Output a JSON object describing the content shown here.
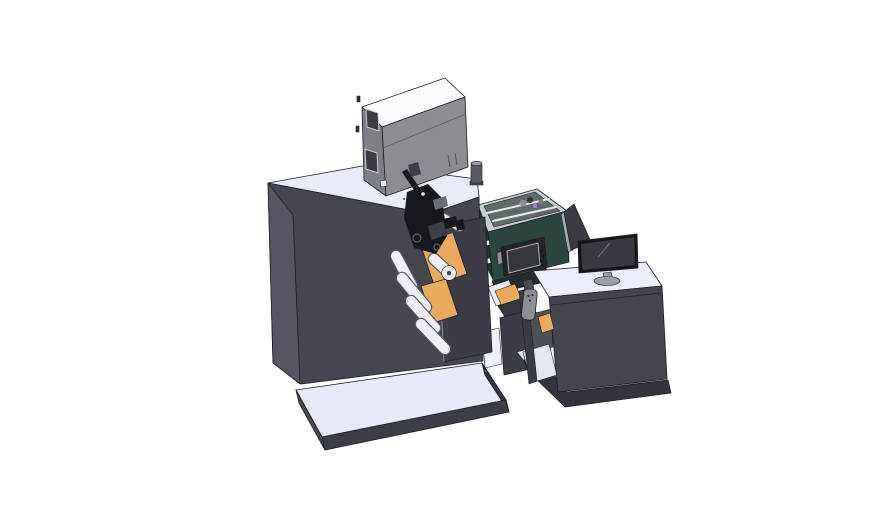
{
  "description": "3D CAD isometric render of an industrial label printing machine: large dark cabinet on a light floor platform with a gray enclosure box on top, orange material rolls and white guide rollers on a mount plate, black print-head assembly, dark teal process chamber with control-panel screen, transfer bridge with hanging pendant remote, and an operator desk with a flat monitor on a white desktop",
  "parts": [
    "process-chamber",
    "chamber-control-panel",
    "monitor-side-panel",
    "main-cabinet",
    "top-unit-box",
    "exhaust-canister",
    "roll-mount-plate",
    "material-rolls",
    "guide-rollers",
    "print-head-assembly",
    "transfer-bridge",
    "floor-platform",
    "desk-base",
    "operator-desk",
    "desk-shelf",
    "pendant-remote",
    "monitor"
  ],
  "colors": {
    "background": "#ffffff",
    "outline": "#1e1f23",
    "cabinetTop": "#e8ecf7",
    "cabinetFront": "#45464f",
    "cabinetSide": "#555662",
    "platformTop": "#e6eaf6",
    "platformFront": "#3c3d47",
    "platformSideL": "#474854",
    "platformSideR": "#343540",
    "boxTop": "#fbfcfe",
    "boxFront": "#8b8d93",
    "boxSide": "#7d7f85",
    "boxWindow": "#3c3d44",
    "boxWindowFrame": "#c9cbd1",
    "boxSeam": "#5c5e63",
    "boxGroove": "#55575e",
    "boxTab": "#2e2f34",
    "boxSquare": "#f4f6fa",
    "canisterBody": "#585a61",
    "canisterCap": "#9ba0a8",
    "canisterFoot": "#494b51",
    "plate": "#3b3c45",
    "plateEdge": "#8a8c94",
    "roller": "#edeff5",
    "rollerRim": "#595a61",
    "rollerHub": "#45464c",
    "orange": "#e9aa5e",
    "mech": "#17181b",
    "mechMid": "#3e3f46",
    "mechGray": "#6b6d73",
    "mechDot": "#e8eaee",
    "markDot": "#26272c",
    "chamberRim": "#c8cdd5",
    "chamberInterior": "#5e6b68",
    "chamberFront": "#2b463e",
    "chamberSide": "#1f342e",
    "chamberLower": "#262b2c",
    "strut": "#e9ebf1",
    "blobGray": "#8f9197",
    "blobDark": "#34353b",
    "blobMagenta": "#bd6fd6",
    "blobGray2": "#75777d",
    "hinge": "#f1f3f7",
    "panelBody": "#232423",
    "panelScreen": "#36373d",
    "panelScreenEdge": "#aeb1b7",
    "panelButton": "#151617",
    "panelKnob": "#8d8f95",
    "sidePanel": "#3a3b43",
    "sidePanelEdge": "#a7a9b0",
    "deskTop": "#ebeef8",
    "deskFront": "#44454e",
    "deskSeam": "#23242a",
    "shelfWall": "#4e4f59",
    "shelfFloor": "#e3e7f1",
    "deskWallThin": "#3a3b44",
    "deskBase": "#32333b",
    "deskBaseLight": "#e4e8f2",
    "rampWhite": "#e8ebf3",
    "bridgeBeam": "#35363e",
    "bridgeColumn": "#3b3c45",
    "gapLight": "#eef1f7",
    "pendantBody": "#8c8e94",
    "pendantButton": "#2c2d31",
    "pendantBracket": "#4a4b52",
    "monitorBezel": "#151618",
    "monitorScreen": "#393a41",
    "monitorReflect": "#71727a",
    "monitorNeck": "#9aa0ab",
    "monitorBase": "#989eaa"
  }
}
